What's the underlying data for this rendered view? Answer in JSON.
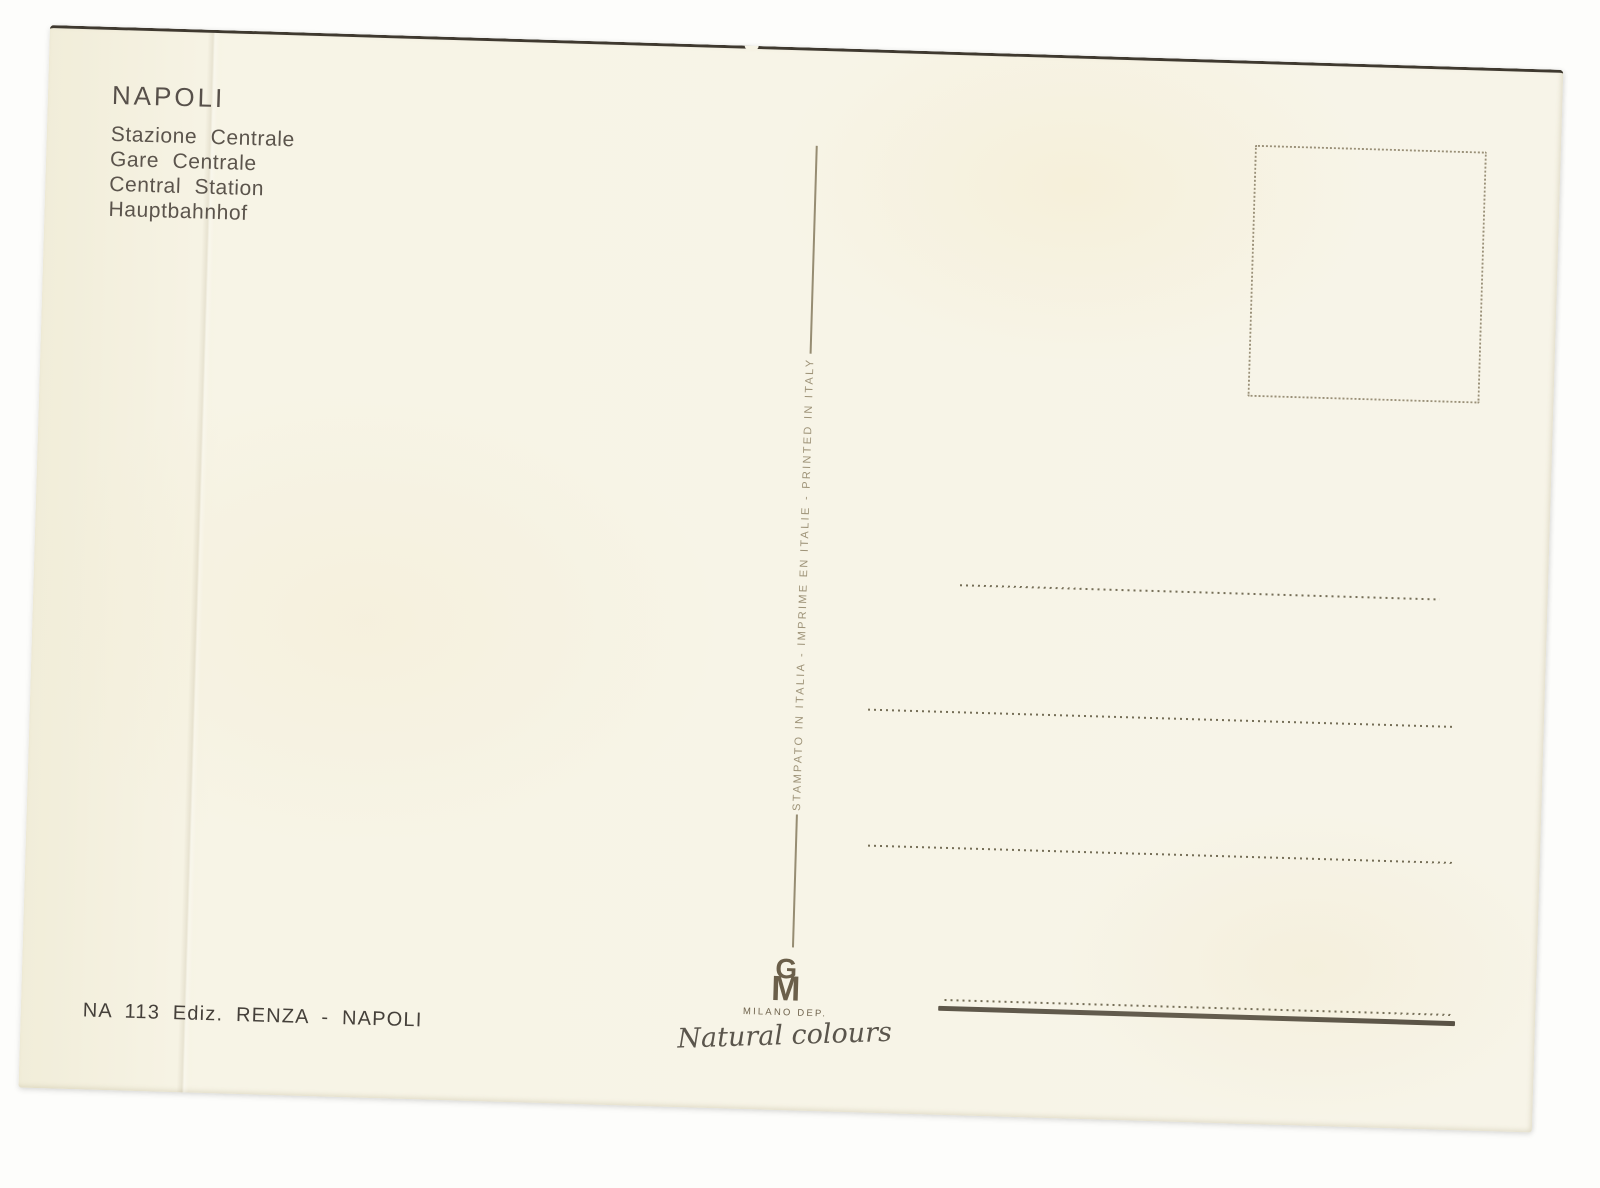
{
  "postcard": {
    "front_caption": {
      "title": "NAPOLI",
      "subtitle_lines": [
        "Stazione Centrale",
        "Gare Centrale",
        "Central Station",
        "Hauptbahnhof"
      ]
    },
    "divider": {
      "imprint": "STAMPATO IN ITALIA - IMPRIME EN ITALIE - PRINTED IN ITALY"
    },
    "publisher_credit": "NA 113 Ediz. RENZA - NAPOLI",
    "logo": {
      "monogram_top": "G",
      "monogram_bottom": "M",
      "caption": "MILANO DEP.",
      "tagline": "Natural colours"
    },
    "colors": {
      "card_paper": "#f7f4e6",
      "ink_dark": "#57504a",
      "ink_publisher": "#45403a",
      "ink_imprint": "#9e9378",
      "dotted_line": "#756e57",
      "thick_line": "#5e574a",
      "logo_brown": "#6b5f4a",
      "top_edge": "#3f392f"
    }
  }
}
